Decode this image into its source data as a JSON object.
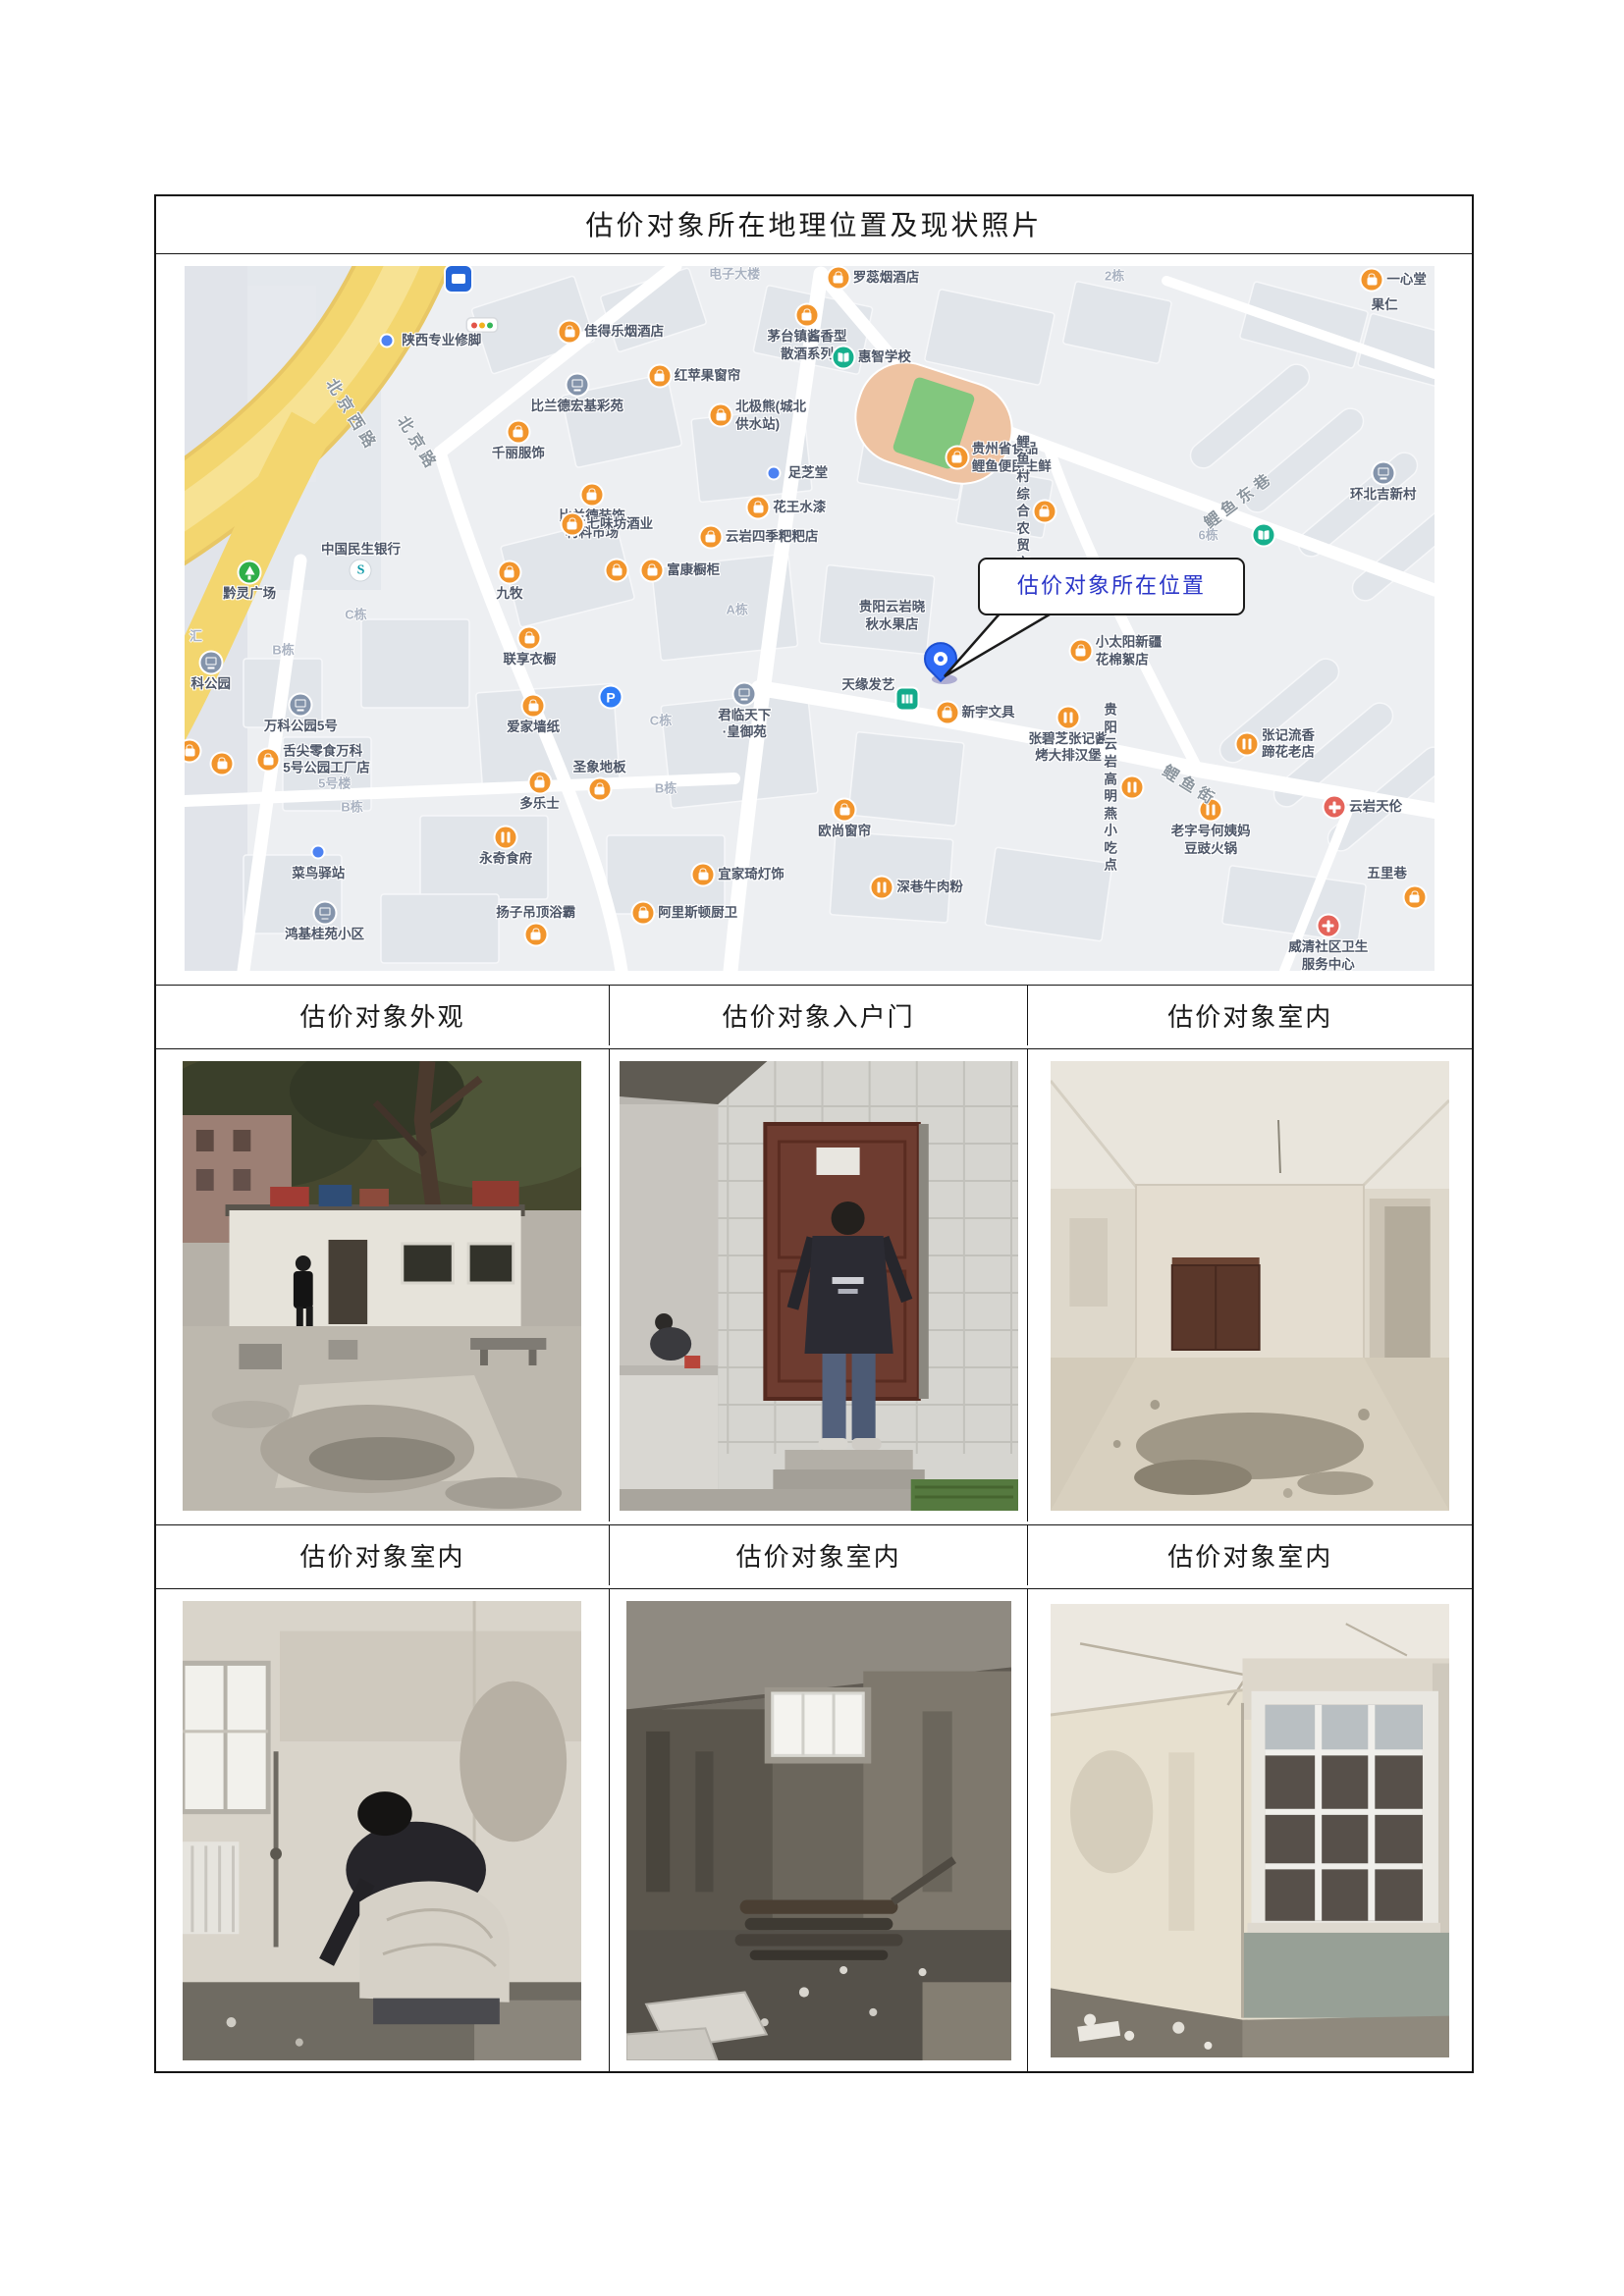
{
  "page": {
    "title": "估价对象所在地理位置及现状照片"
  },
  "captions_row1": [
    "估价对象外观",
    "估价对象入户门",
    "估价对象室内"
  ],
  "captions_row2": [
    "估价对象室内",
    "估价对象室内",
    "估价对象室内"
  ],
  "map": {
    "callout": {
      "label": "估价对象所在位置",
      "text_color": "#2a35c8"
    },
    "accent_colors": {
      "shop_icon": "#f2952c",
      "school_icon": "#17b08d",
      "hospital_icon": "#e4635a",
      "road_yellow": "#f2d469",
      "pin_blue": "#2e69f5"
    },
    "road_labels": [
      {
        "t": "北京西路",
        "x": 13.5,
        "y": 21.0,
        "rot": 58
      },
      {
        "t": "北京路",
        "x": 18.8,
        "y": 25.0,
        "rot": 58
      },
      {
        "t": "鲤鱼东巷",
        "x": 84.3,
        "y": 33.0,
        "rot": -37
      },
      {
        "t": "鲤鱼街",
        "x": 80.5,
        "y": 73.5,
        "rot": 32
      }
    ],
    "building_labels": [
      {
        "t": "2栋",
        "x": 74.4,
        "y": 1.2
      },
      {
        "t": "6栋",
        "x": 81.9,
        "y": 38.0
      },
      {
        "t": "A栋",
        "x": 44.2,
        "y": 48.6
      },
      {
        "t": "C栋",
        "x": 13.7,
        "y": 49.3
      },
      {
        "t": "B栋",
        "x": 7.9,
        "y": 54.3
      },
      {
        "t": "C栋",
        "x": 38.1,
        "y": 64.3
      },
      {
        "t": "B栋",
        "x": 38.5,
        "y": 73.9
      },
      {
        "t": "B栋",
        "x": 13.4,
        "y": 76.6
      },
      {
        "t": "5号楼",
        "x": 12.0,
        "y": 73.3
      },
      {
        "t": "汇",
        "x": 0.9,
        "y": 52.4
      },
      {
        "t": "电子大楼",
        "x": 44.0,
        "y": 1.0
      }
    ],
    "pois": [
      {
        "x": 21.9,
        "y": 1.8,
        "icon": "bus"
      },
      {
        "x": 23.8,
        "y": 8.4,
        "icon": "traffic"
      },
      {
        "x": 16.2,
        "y": 10.6,
        "icon": "dot",
        "label": "陕西专业修脚",
        "pos": "right"
      },
      {
        "x": 52.3,
        "y": 1.7,
        "icon": "shop",
        "label": "罗蕊烟酒店",
        "pos": "right"
      },
      {
        "x": 95.0,
        "y": 2.0,
        "icon": "shop",
        "label": "一心堂",
        "pos": "right"
      },
      {
        "x": 96.0,
        "y": 5.6,
        "icon": "none",
        "label": "果仁",
        "pos": "center"
      },
      {
        "x": 30.8,
        "y": 9.4,
        "icon": "shop",
        "label": "佳得乐烟酒店",
        "pos": "right"
      },
      {
        "x": 49.8,
        "y": 7.0,
        "icon": "shop",
        "label": "茅台镇酱香型\n散酒系列",
        "pos": "below"
      },
      {
        "x": 38.0,
        "y": 15.6,
        "icon": "shop",
        "label": "红苹果窗帘",
        "pos": "right"
      },
      {
        "x": 52.7,
        "y": 13.0,
        "icon": "school",
        "label": "惠智学校",
        "pos": "right"
      },
      {
        "x": 42.9,
        "y": 21.2,
        "icon": "shop",
        "label": "北极熊(城北\n供水站)",
        "pos": "right"
      },
      {
        "x": 61.8,
        "y": 27.2,
        "icon": "shop",
        "label": "贵州省食品\n鲤鱼便民生鲜",
        "pos": "right"
      },
      {
        "x": 31.4,
        "y": 16.8,
        "icon": "residence",
        "label": "比兰德宏基彩苑",
        "pos": "below"
      },
      {
        "x": 26.7,
        "y": 23.6,
        "icon": "shop",
        "label": "千丽服饰",
        "pos": "below"
      },
      {
        "x": 47.1,
        "y": 29.4,
        "icon": "dot",
        "label": "足芝堂",
        "pos": "right"
      },
      {
        "x": 32.6,
        "y": 32.4,
        "icon": "shop",
        "label": "比兰德装饰\n材料市场",
        "pos": "below"
      },
      {
        "x": 45.9,
        "y": 34.2,
        "icon": "shop",
        "label": "花王水漆",
        "pos": "right"
      },
      {
        "x": 42.1,
        "y": 38.4,
        "icon": "shop",
        "label": "云岩四季粑粑店",
        "pos": "right"
      },
      {
        "x": 31.0,
        "y": 36.6,
        "icon": "shop",
        "label": "七味坊酒业",
        "pos": "right"
      },
      {
        "x": 68.8,
        "y": 34.8,
        "icon": "shop",
        "label": "鲤鱼村综合\n农贸市场",
        "pos": "left"
      },
      {
        "x": 95.9,
        "y": 29.4,
        "icon": "residence",
        "label": "环北吉新村",
        "pos": "below"
      },
      {
        "x": 14.1,
        "y": 43.2,
        "icon": "bank",
        "label": "中国民生银行",
        "pos": "above"
      },
      {
        "x": 5.2,
        "y": 43.4,
        "icon": "park",
        "label": "黔灵广场",
        "pos": "below"
      },
      {
        "x": 34.6,
        "y": 43.2,
        "icon": "shop"
      },
      {
        "x": 37.4,
        "y": 43.2,
        "icon": "shop",
        "label": "富康橱柜",
        "pos": "right"
      },
      {
        "x": 26.0,
        "y": 43.4,
        "icon": "shop",
        "label": "九牧",
        "pos": "below"
      },
      {
        "x": 27.6,
        "y": 52.8,
        "icon": "shop",
        "label": "联享衣橱",
        "pos": "below"
      },
      {
        "x": 56.6,
        "y": 49.6,
        "icon": "none",
        "label": "贵阳云岩晓\n秋水果店",
        "pos": "center"
      },
      {
        "x": 54.7,
        "y": 59.5,
        "icon": "none",
        "label": "天缘发艺",
        "pos": "center"
      },
      {
        "x": 57.8,
        "y": 61.4,
        "icon": "wc"
      },
      {
        "x": 61.0,
        "y": 63.4,
        "icon": "shop",
        "label": "新宇文具",
        "pos": "right"
      },
      {
        "x": 71.7,
        "y": 54.6,
        "icon": "shop",
        "label": "小太阳新疆\n花棉絮店",
        "pos": "right"
      },
      {
        "x": 86.3,
        "y": 38.2,
        "icon": "school"
      },
      {
        "x": 44.8,
        "y": 60.7,
        "icon": "residence",
        "label": "君临天下\n·皇御苑",
        "pos": "below"
      },
      {
        "x": 34.1,
        "y": 61.2,
        "icon": "parking"
      },
      {
        "x": 27.9,
        "y": 62.4,
        "icon": "shop",
        "label": "爱家墙纸",
        "pos": "below"
      },
      {
        "x": 70.7,
        "y": 64.0,
        "icon": "food",
        "label": "张碧芝张记酱\n烤大排汉堡",
        "pos": "below"
      },
      {
        "x": 85.0,
        "y": 67.8,
        "icon": "food",
        "label": "张记流香\n蹄花老店",
        "pos": "right"
      },
      {
        "x": 92.0,
        "y": 76.8,
        "icon": "hospital",
        "label": "云岩天伦",
        "pos": "right"
      },
      {
        "x": 33.2,
        "y": 74.2,
        "icon": "shop",
        "label": "圣象地板",
        "pos": "above"
      },
      {
        "x": 28.4,
        "y": 73.2,
        "icon": "shop",
        "label": "多乐士",
        "pos": "below"
      },
      {
        "x": 9.3,
        "y": 62.2,
        "icon": "residence",
        "label": "万科公园5号",
        "pos": "below"
      },
      {
        "x": 2.1,
        "y": 56.2,
        "icon": "residence",
        "label": "科公园",
        "pos": "below"
      },
      {
        "x": 3.0,
        "y": 70.6,
        "icon": "shop"
      },
      {
        "x": 6.7,
        "y": 70.0,
        "icon": "shop",
        "label": "舌尖零食万科\n5号公园工厂店",
        "pos": "right"
      },
      {
        "x": 0.4,
        "y": 68.8,
        "icon": "shop"
      },
      {
        "x": 10.7,
        "y": 83.2,
        "icon": "dot",
        "label": "菜鸟驿站",
        "pos": "below"
      },
      {
        "x": 25.7,
        "y": 81.0,
        "icon": "food",
        "label": "永奇食府",
        "pos": "below"
      },
      {
        "x": 11.2,
        "y": 91.8,
        "icon": "residence",
        "label": "鸿基桂苑小区",
        "pos": "below"
      },
      {
        "x": 28.1,
        "y": 94.8,
        "icon": "shop",
        "label": "扬子吊顶浴霸",
        "pos": "above"
      },
      {
        "x": 52.8,
        "y": 77.2,
        "icon": "shop",
        "label": "欧尚窗帘",
        "pos": "below"
      },
      {
        "x": 41.5,
        "y": 86.4,
        "icon": "shop",
        "label": "宜家琦灯饰",
        "pos": "right"
      },
      {
        "x": 55.8,
        "y": 88.2,
        "icon": "food",
        "label": "深巷牛肉粉",
        "pos": "right"
      },
      {
        "x": 36.7,
        "y": 91.8,
        "icon": "shop",
        "label": "阿里斯顿厨卫",
        "pos": "right"
      },
      {
        "x": 82.1,
        "y": 77.2,
        "icon": "food",
        "label": "老字号何姨妈\n豆豉火锅",
        "pos": "below"
      },
      {
        "x": 75.8,
        "y": 74.0,
        "icon": "food",
        "label": "贵阳云岩\n高明燕小吃点",
        "pos": "left"
      },
      {
        "x": 96.2,
        "y": 86.2,
        "icon": "none",
        "label": "五里巷",
        "pos": "center"
      },
      {
        "x": 98.4,
        "y": 89.6,
        "icon": "shop"
      },
      {
        "x": 91.5,
        "y": 93.6,
        "icon": "hospital",
        "label": "威清社区卫生\n服务中心",
        "pos": "below"
      }
    ]
  }
}
